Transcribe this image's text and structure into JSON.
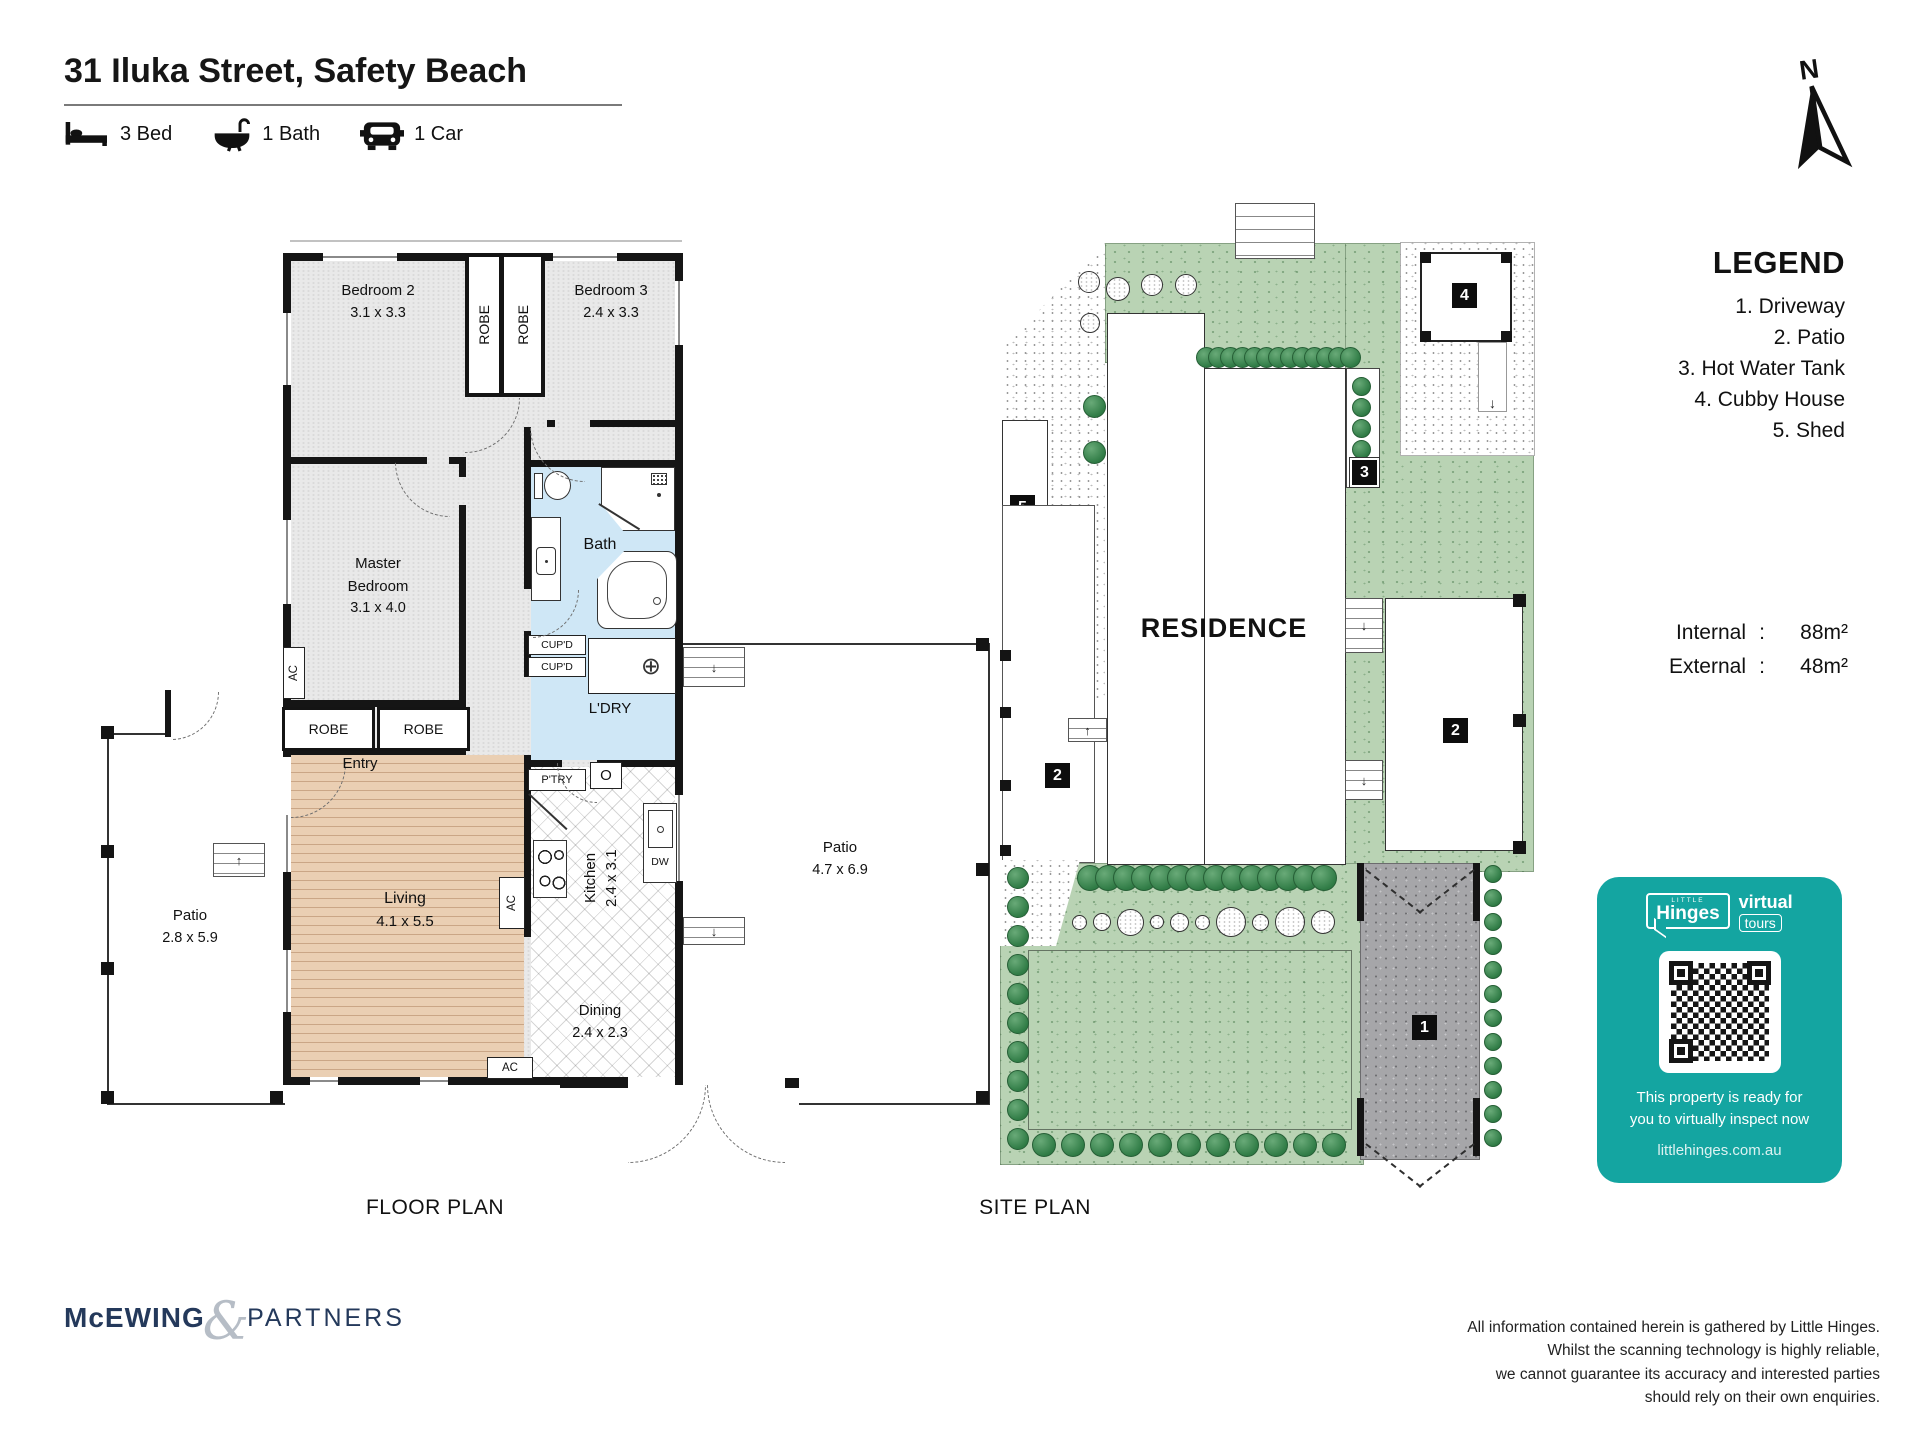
{
  "header": {
    "title": "31 Iluka Street, Safety Beach",
    "features": [
      {
        "icon": "bed-icon",
        "label": "3 Bed"
      },
      {
        "icon": "bath-icon",
        "label": "1 Bath"
      },
      {
        "icon": "car-icon",
        "label": "1 Car"
      }
    ]
  },
  "compass": {
    "label": "N"
  },
  "floor_plan": {
    "caption": "FLOOR PLAN",
    "labels": {
      "robe": "ROBE",
      "cupboard": "CUP'D",
      "ac": "AC",
      "entry": "Entry",
      "oven": "O",
      "dishwasher": "DW",
      "pantry": "P'TRY"
    },
    "rooms": {
      "bedroom2": {
        "name": "Bedroom 2",
        "dims": "3.1 x 3.3"
      },
      "bedroom3": {
        "name": "Bedroom 3",
        "dims": "2.4 x 3.3"
      },
      "master": {
        "name1": "Master",
        "name2": "Bedroom",
        "dims": "3.1 x 4.0"
      },
      "bath": {
        "name": "Bath"
      },
      "laundry": {
        "name": "L'DRY"
      },
      "kitchen": {
        "name": "Kitchen",
        "dims": "2.4 x 3.1"
      },
      "living": {
        "name": "Living",
        "dims": "4.1 x 5.5"
      },
      "dining": {
        "name": "Dining",
        "dims": "2.4 x 2.3"
      },
      "patio_left": {
        "name": "Patio",
        "dims": "2.8 x 5.9"
      },
      "patio_right": {
        "name": "Patio",
        "dims": "4.7 x 6.9"
      }
    }
  },
  "site_plan": {
    "caption": "SITE PLAN",
    "residence": "RESIDENCE",
    "markers": {
      "driveway": "1",
      "patio_side": "2",
      "patio_rear": "2",
      "hot_water": "3",
      "cubby": "4",
      "shed": "5"
    }
  },
  "legend": {
    "title": "LEGEND",
    "items": [
      "1. Driveway",
      "2. Patio",
      "3. Hot Water Tank",
      "4. Cubby House",
      "5. Shed"
    ]
  },
  "areas": {
    "internal_label": "Internal",
    "colon": ":",
    "internal_value": "88m²",
    "external_label": "External",
    "external_value": "48m²"
  },
  "badge": {
    "color": "#14a5a1",
    "brand_top": "LITTLE",
    "brand": "Hinges",
    "tag1": "virtual",
    "tag2": "tours",
    "line1": "This property is ready for",
    "line2": "you to virtually inspect now",
    "url": "littlehinges.com.au"
  },
  "footer": {
    "brand1": "McEWING",
    "amp": "&",
    "brand2": "PARTNERS",
    "disclaimer": [
      "All information contained herein is gathered by Little Hinges.",
      "Whilst the scanning technology is highly reliable,",
      "we cannot guarantee its accuracy and interested parties",
      "should rely on their own enquiries."
    ]
  }
}
